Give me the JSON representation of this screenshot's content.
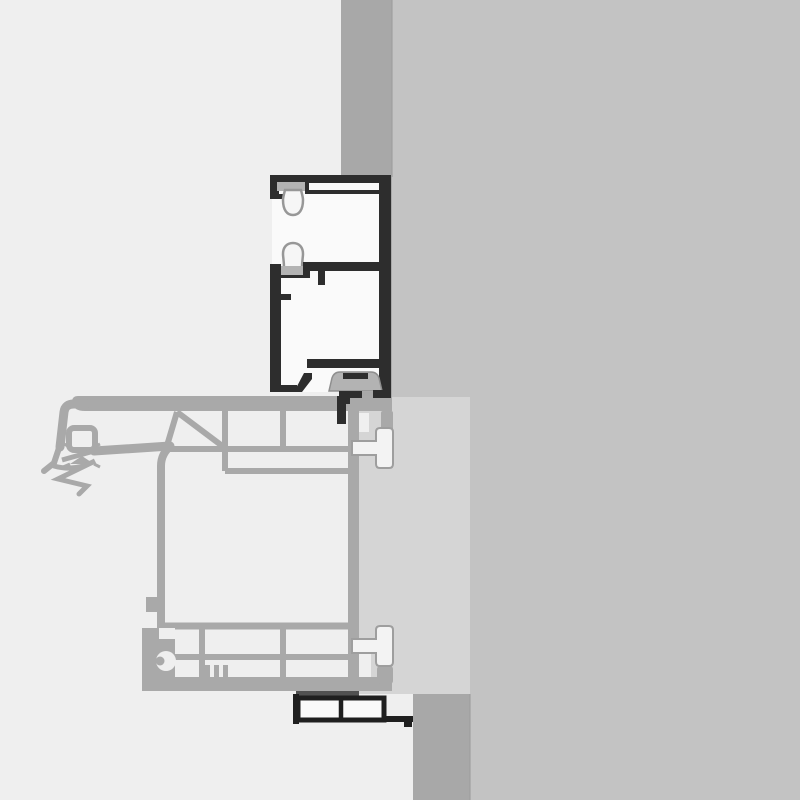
{
  "scene": {
    "description_colors_only": true,
    "background_color": "#efefef",
    "wall_color": "#c3c3c3",
    "reveal_band_color": "#a8a8a8",
    "panel_color": "#d5d5d5",
    "sash_profile_color": "#a9a9a9",
    "frame_profile_color": "#2d2d2d",
    "frame_fill_color": "#fafafa",
    "gasket_solid_color": "#b3b3b3",
    "gasket_outline_color": "#979797",
    "gasket_fill_color": "#f6f6f6",
    "screw_fill_color": "#f3f3f3",
    "screw_outline_color": "#9e9e9e",
    "tape_color": "#515151",
    "trim_profile_color": "#1f1f1f",
    "seam_color": "#9c9c9c"
  }
}
